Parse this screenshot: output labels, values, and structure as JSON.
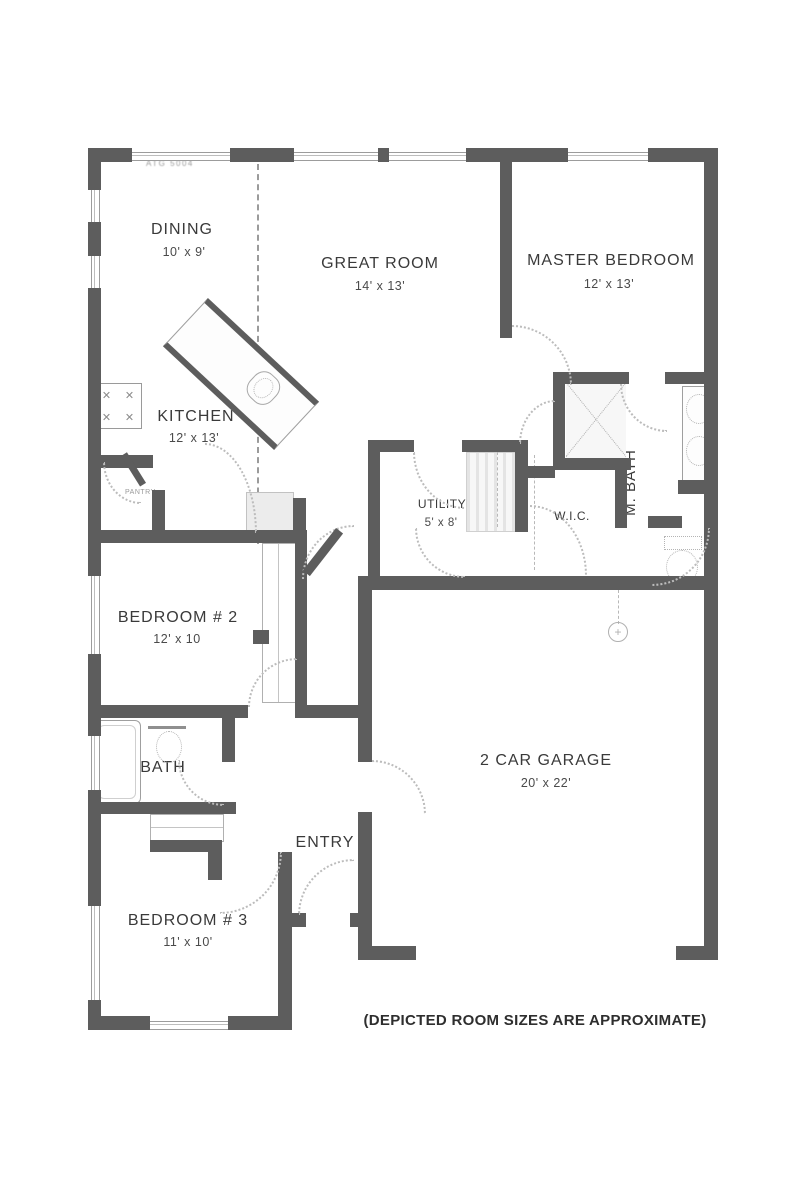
{
  "document": {
    "stamp": "ATG 5004",
    "footnote": "(DEPICTED ROOM SIZES ARE APPROXIMATE)"
  },
  "rooms": {
    "dining": {
      "name": "DINING",
      "size": "10' x 9'"
    },
    "great_room": {
      "name": "GREAT ROOM",
      "size": "14' x 13'"
    },
    "master_bedroom": {
      "name": "MASTER BEDROOM",
      "size": "12' x 13'"
    },
    "kitchen": {
      "name": "KITCHEN",
      "size": "12' x 13'"
    },
    "utility": {
      "name": "UTILITY",
      "size": "5' x 8'"
    },
    "wic": {
      "name": "W.I.C."
    },
    "master_bath": {
      "name": "M. BATH"
    },
    "bedroom_2": {
      "name": "BEDROOM # 2",
      "size": "12' x 10"
    },
    "bath": {
      "name": "BATH"
    },
    "entry": {
      "name": "ENTRY"
    },
    "bedroom_3": {
      "name": "BEDROOM # 3",
      "size": "11' x 10'"
    },
    "garage": {
      "name": "2 CAR GARAGE",
      "size": "20' x 22'"
    },
    "pantry": {
      "name": "PANTRY"
    }
  },
  "colors": {
    "wall": "#5d5d5d",
    "fixture_line": "#9f9f9f",
    "door_arc": "#bcbcbc",
    "text": "#3a3a3a"
  }
}
